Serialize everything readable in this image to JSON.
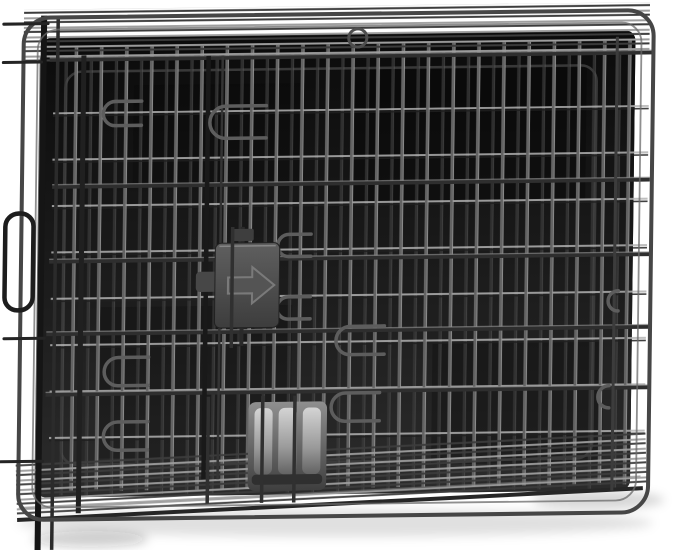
{
  "scene": {
    "type": "product-photo",
    "description": "Black folded metal wire dog crate (collapsed flat) with dark plastic floor tray, gray slide-bolt latch with embossed right arrow, and ridged gray tray grip, photographed on a white studio background with a soft shadow underneath",
    "subject": "folded wire dog crate",
    "state": "folded flat, slightly tilted",
    "material": "black powder-coated steel wire with plastic tray",
    "background": "white seamless",
    "parts": [
      {
        "name": "wire-mesh-panels",
        "description": "overlapping folded wire grid panels, vertical wires about 25px apart crossed by horizontal rails"
      },
      {
        "name": "outer-frame",
        "description": "rounded-corner double steel wire frame around the whole crate"
      },
      {
        "name": "top-folded-panels",
        "description": "dense band of stacked horizontal wires along the top edge"
      },
      {
        "name": "bottom-folded-panels",
        "description": "dense band of stacked horizontal wires along the sloping bottom edge"
      },
      {
        "name": "plastic-tray",
        "description": "dark black plastic floor tray visible behind the mesh"
      },
      {
        "name": "slide-bolt-latch",
        "description": "dark gray plastic slide latch with embossed arrow pointing right, upper-left of center"
      },
      {
        "name": "tray-handle",
        "description": "light gray ridged plastic grip of the tray, lower-left of center"
      },
      {
        "name": "wire-latch-loops",
        "description": "bent wire U-loops and hooks at door latch points"
      },
      {
        "name": "left-carry-loop",
        "description": "wire loop protruding from the left edge"
      },
      {
        "name": "top-hanger-loop",
        "description": "small round wire loop at top center"
      },
      {
        "name": "drop-shadow",
        "description": "soft gray shadow under the crate"
      }
    ],
    "colors": {
      "background": "#ffffff",
      "wire_dark": "#1f1f1f",
      "wire_mid": "#5c5c5c",
      "wire_light": "#a8a8a8",
      "tray": "#131313",
      "tray_edge": "#3d3d3d",
      "latch_body": "#474747",
      "latch_arrow": "#7d7d7d",
      "handle_light": "#b5b5b5",
      "handle_dark": "#4a4a4a",
      "shadow": "#1a1a1a"
    }
  }
}
